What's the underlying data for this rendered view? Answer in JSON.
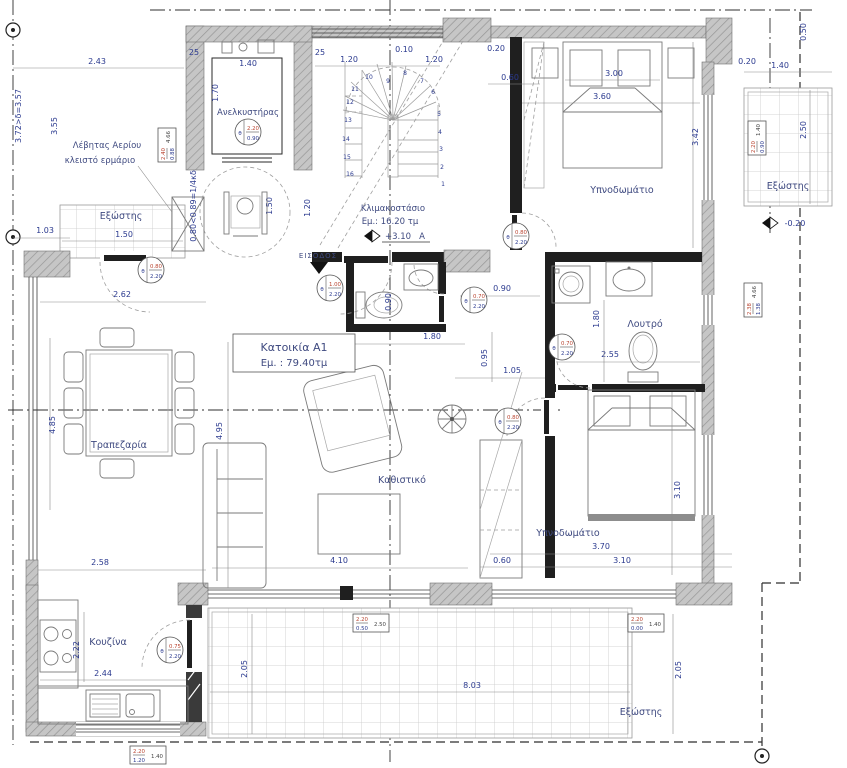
{
  "drawing": {
    "unit": {
      "name": "Κατοικία A1",
      "area": "Εμ. : 79.40τμ"
    },
    "rooms": {
      "elevator": "Ανελκυστήρας",
      "bedroom1": "Υπνοδωμάτιο",
      "bedroom2": "Υπνοδωμάτιο",
      "bathroom": "Λουτρό",
      "kitchen": "Κουζίνα",
      "dining": "Τραπεζαρία",
      "living": "Καθιστικό",
      "balcony_left": "Εξώστης",
      "balcony_right": "Εξώστης",
      "terrace": "Εξώστης",
      "entrance": "ΕΙΣΟΔΟΣ"
    },
    "stair": {
      "name": "Κλιμακοστάσιο",
      "area": "Εμ.: 16.20 τμ",
      "level": "+3.10",
      "letter": "A",
      "steps": [
        "1",
        "2",
        "3",
        "4",
        "5",
        "6",
        "7",
        "8",
        "9",
        "10",
        "11",
        "12",
        "13",
        "14",
        "15",
        "16"
      ]
    },
    "notes": {
      "boiler1": "Λέβητας Αερίου",
      "boiler2": "κλειστό ερμάριο",
      "balcony_right_level": "-0.20"
    },
    "dims": {
      "top_left": "2.43",
      "hall_h": "3.55",
      "left_total": "3.72>δ=3.57",
      "left_small": "1.03",
      "sill_note": "0.80<0.89=1/4κδ",
      "balcony_left_w": "1.50",
      "hall_w": "2.62",
      "elev_side_l": "25",
      "elev_w": "1.40",
      "elev_h": "1.70",
      "elev_side_r": "25",
      "stair_a": "1.20",
      "stair_b": "0.10",
      "stair_c": "1.20",
      "stair_d": "0.20",
      "stair_e": "0.60",
      "lobby_w": "1.50",
      "lobby_w2": "1.20",
      "bed1_bed": "3.00",
      "bed1_w": "3.60",
      "bed1_h": "3.42",
      "balc_r_a": "0.50",
      "balc_r_b": "0.20",
      "balc_r_c": "1.40",
      "balc_r_d": "2.50",
      "wc_w": "0.90",
      "cor_a": "0.90",
      "wc_len": "1.80",
      "cor_b": "0.95",
      "cor_c": "1.05",
      "bath_d": "1.80",
      "bath_w": "2.55",
      "bed2_h": "3.10",
      "bed2_w": "3.70",
      "bed2_w2": "3.10",
      "closet_w": "0.60",
      "living_w": "4.10",
      "living_h": "4.95",
      "dining_h": "4.85",
      "dining_w": "2.58",
      "kitchen_h": "2.22",
      "kitchen_w": "2.44",
      "terr_h_l": "2.05",
      "terr_w": "8.03",
      "terr_h_r": "2.05"
    },
    "door_tags": {
      "sym": "θ",
      "elevator": {
        "t": "2.20",
        "b": "0.90"
      },
      "entrance": {
        "t": "1.00",
        "b": "2.20"
      },
      "balcony": {
        "t": "0.80",
        "b": "2.20"
      },
      "bedroom1": {
        "t": "0.80",
        "b": "2.20"
      },
      "wc": {
        "t": "0.70",
        "b": "2.20"
      },
      "bath": {
        "t": "0.70",
        "b": "2.20"
      },
      "bedroom2": {
        "t": "0.80",
        "b": "2.20"
      },
      "kitchen": {
        "t": "0.75",
        "b": "2.20"
      }
    },
    "window_tags": {
      "left_wall": {
        "a": "2.40",
        "b": "0.88",
        "c": "4.66"
      },
      "right_wall": {
        "a": "2.38",
        "b": "1.38",
        "c": "4.66"
      },
      "balcony_right": {
        "a": "2.20",
        "b": "0.90",
        "c": "1.40"
      },
      "terrace_center": {
        "a": "2.20",
        "b": "0.50",
        "c": "2.50"
      },
      "terrace_right": {
        "a": "2.20",
        "b": "0.00",
        "c": "1.40"
      },
      "kitchen": {
        "a": "2.20",
        "b": "1.20",
        "c": "1.40"
      }
    }
  }
}
